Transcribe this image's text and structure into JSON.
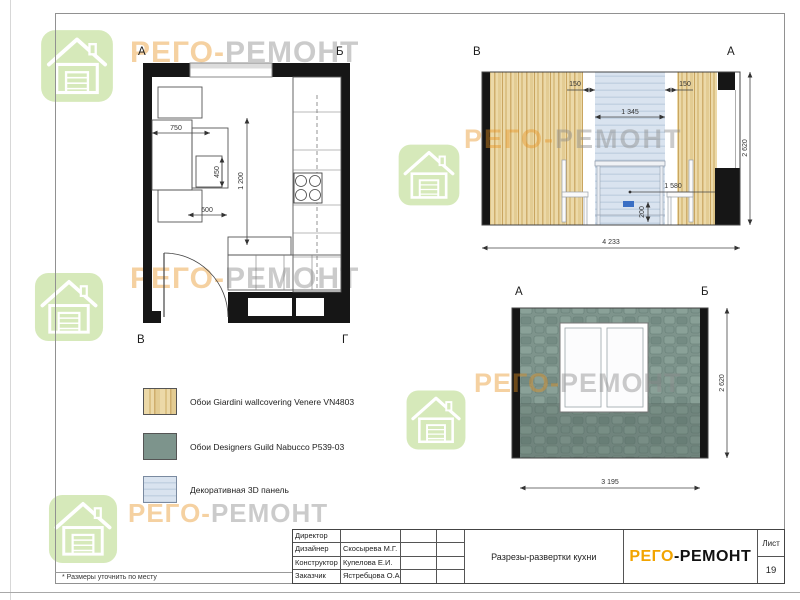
{
  "watermarks": {
    "brand_left": "РЕГО-",
    "brand_right": "РЕМОНТ"
  },
  "floor_plan": {
    "corners": {
      "tl": "А",
      "tr": "Б",
      "bl": "В",
      "br": "Г"
    },
    "dims": {
      "d750": "750",
      "d1200": "1 200",
      "d450": "450",
      "d600": "600"
    }
  },
  "elevation_va": {
    "corner_left": "В",
    "corner_right": "А",
    "dims": {
      "gap_left": "150",
      "panel": "1 345",
      "gap_right": "150",
      "leader": "1 580",
      "socket": "200",
      "width": "4 233",
      "height": "2 620"
    }
  },
  "elevation_ab": {
    "corner_left": "А",
    "corner_right": "Б",
    "dims": {
      "width": "3 195",
      "height": "2 620"
    }
  },
  "legend": {
    "items": [
      {
        "label": "Обои Giardini wallcovering Venere VN4803"
      },
      {
        "label": "Обои Designers Guild Nabucco P539-03"
      },
      {
        "label": "Декоративная 3D панель"
      }
    ]
  },
  "title_block": {
    "rows": [
      {
        "role": "Директор",
        "name": ""
      },
      {
        "role": "Дизайнер",
        "name": "Скосырева М.Г."
      },
      {
        "role": "Конструктор",
        "name": "Купелова Е.И."
      },
      {
        "role": "Заказчик",
        "name": "Ястребцова О.А."
      }
    ],
    "drawing_title": "Разрезы-развертки кухни",
    "brand_orange": "РЕГО",
    "brand_black": "-РЕМОНТ",
    "sheet_label": "Лист",
    "sheet_number": "19"
  },
  "footnote": "* Размеры уточнить по месту",
  "colors": {
    "wood": "#e7d3a2",
    "teal": "#7d948c",
    "panel_blue": "#d6e1ed",
    "brand_orange": "#f2a400",
    "socket_blue": "#3a6fc4",
    "wall_black": "#161616"
  }
}
